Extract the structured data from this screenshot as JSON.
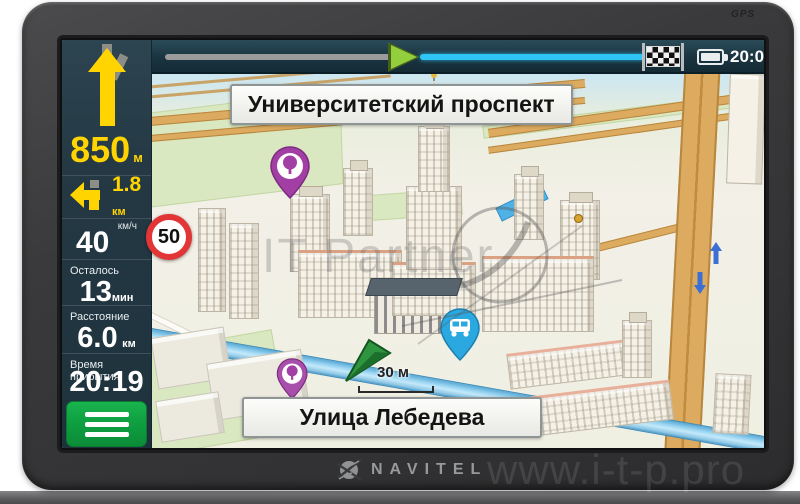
{
  "device": {
    "brand_label": "NAVITEL",
    "gps_label": "GPS"
  },
  "watermark": {
    "center_text": "IT Partner",
    "site_text": "www.i-t-p.pro"
  },
  "status_bar": {
    "time": "20:06",
    "icons": {
      "progress_marker": "route-progress-arrow",
      "finish": "checkered-flag",
      "battery": "battery-full"
    }
  },
  "route_panel": {
    "primary_maneuver": {
      "icon": "straight-ahead-arrow",
      "distance": "850",
      "unit": "м"
    },
    "secondary_maneuver": {
      "icon": "turn-left-arrow",
      "distance": "1.8",
      "unit": "км"
    },
    "speed": {
      "unit_label": "км/ч",
      "value": "40"
    },
    "speed_limit": {
      "value": "50"
    },
    "time_remaining": {
      "label": "Осталось",
      "value": "13",
      "unit": "мин"
    },
    "distance_remaining": {
      "label": "Расстояние",
      "value": "6.0",
      "unit": "км"
    },
    "arrival_time": {
      "label": "Время прибытия",
      "value": "20:19"
    },
    "menu_icon": "hamburger-menu"
  },
  "map": {
    "next_street_sign": "Университетский проспект",
    "current_street_sign": "Улица Лебедева",
    "scale_label": "30 м",
    "pois": [
      {
        "type": "park-pin",
        "color": "#a23fa5"
      },
      {
        "type": "park-pin",
        "color": "#a23fa5"
      },
      {
        "type": "transport-pin",
        "color": "#2ba8e0"
      }
    ],
    "oneway_arrows": [
      "up",
      "down"
    ],
    "vehicle_icon": "navigation-cursor"
  },
  "colors": {
    "accent_yellow": "#ffd400",
    "panel_bg": "#233843",
    "menu_green": "#0fa041",
    "route_line_cyan": "#2fc6f5",
    "route_marker_green": "#93ce3d",
    "speed_limit_red": "#e23535",
    "river_blue": "#7cc4e8",
    "road_tan": "#dcab60",
    "pin_purple": "#a23fa5",
    "pin_blue": "#2ba8e0"
  }
}
